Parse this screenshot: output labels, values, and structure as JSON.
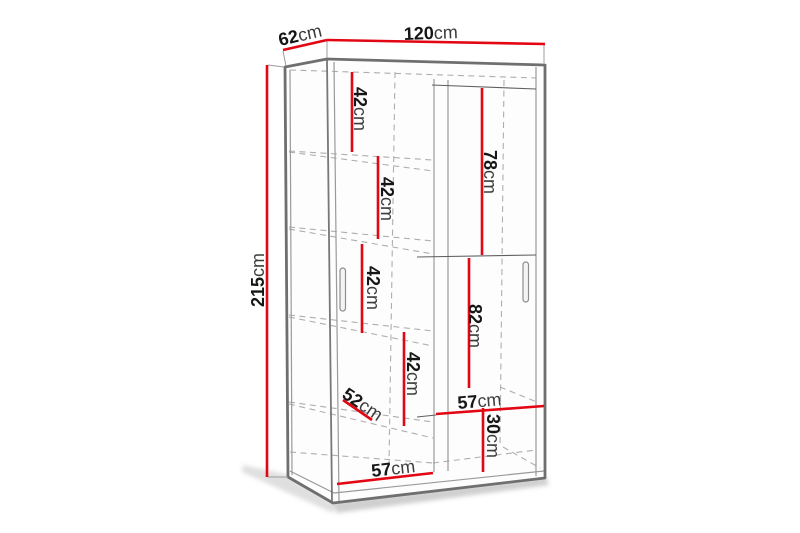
{
  "diagram": {
    "type": "furniture-dimension-diagram",
    "subject": "sliding-door wardrobe with interior shelves",
    "unit": "cm",
    "colors": {
      "dimension_line": "#e30613",
      "body_outline": "#6f6f6f",
      "hidden_edge": "#aeaeae",
      "label_number": "#161616",
      "label_unit": "#3c3c3c",
      "background": "#ffffff"
    },
    "dimensions": {
      "width": {
        "value": "120",
        "unit": "cm"
      },
      "depth": {
        "value": "62",
        "unit": "cm"
      },
      "height": {
        "value": "215",
        "unit": "cm"
      },
      "shelf_gap_1": {
        "value": "42",
        "unit": "cm"
      },
      "shelf_gap_2": {
        "value": "42",
        "unit": "cm"
      },
      "shelf_gap_3": {
        "value": "42",
        "unit": "cm"
      },
      "shelf_gap_4": {
        "value": "42",
        "unit": "cm"
      },
      "right_top_section_height": {
        "value": "78",
        "unit": "cm"
      },
      "right_middle_section_height": {
        "value": "82",
        "unit": "cm"
      },
      "right_section_width": {
        "value": "57",
        "unit": "cm"
      },
      "right_bottom_section_height": {
        "value": "30",
        "unit": "cm"
      },
      "left_section_width": {
        "value": "57",
        "unit": "cm"
      },
      "interior_depth": {
        "value": "52",
        "unit": "cm"
      }
    }
  }
}
